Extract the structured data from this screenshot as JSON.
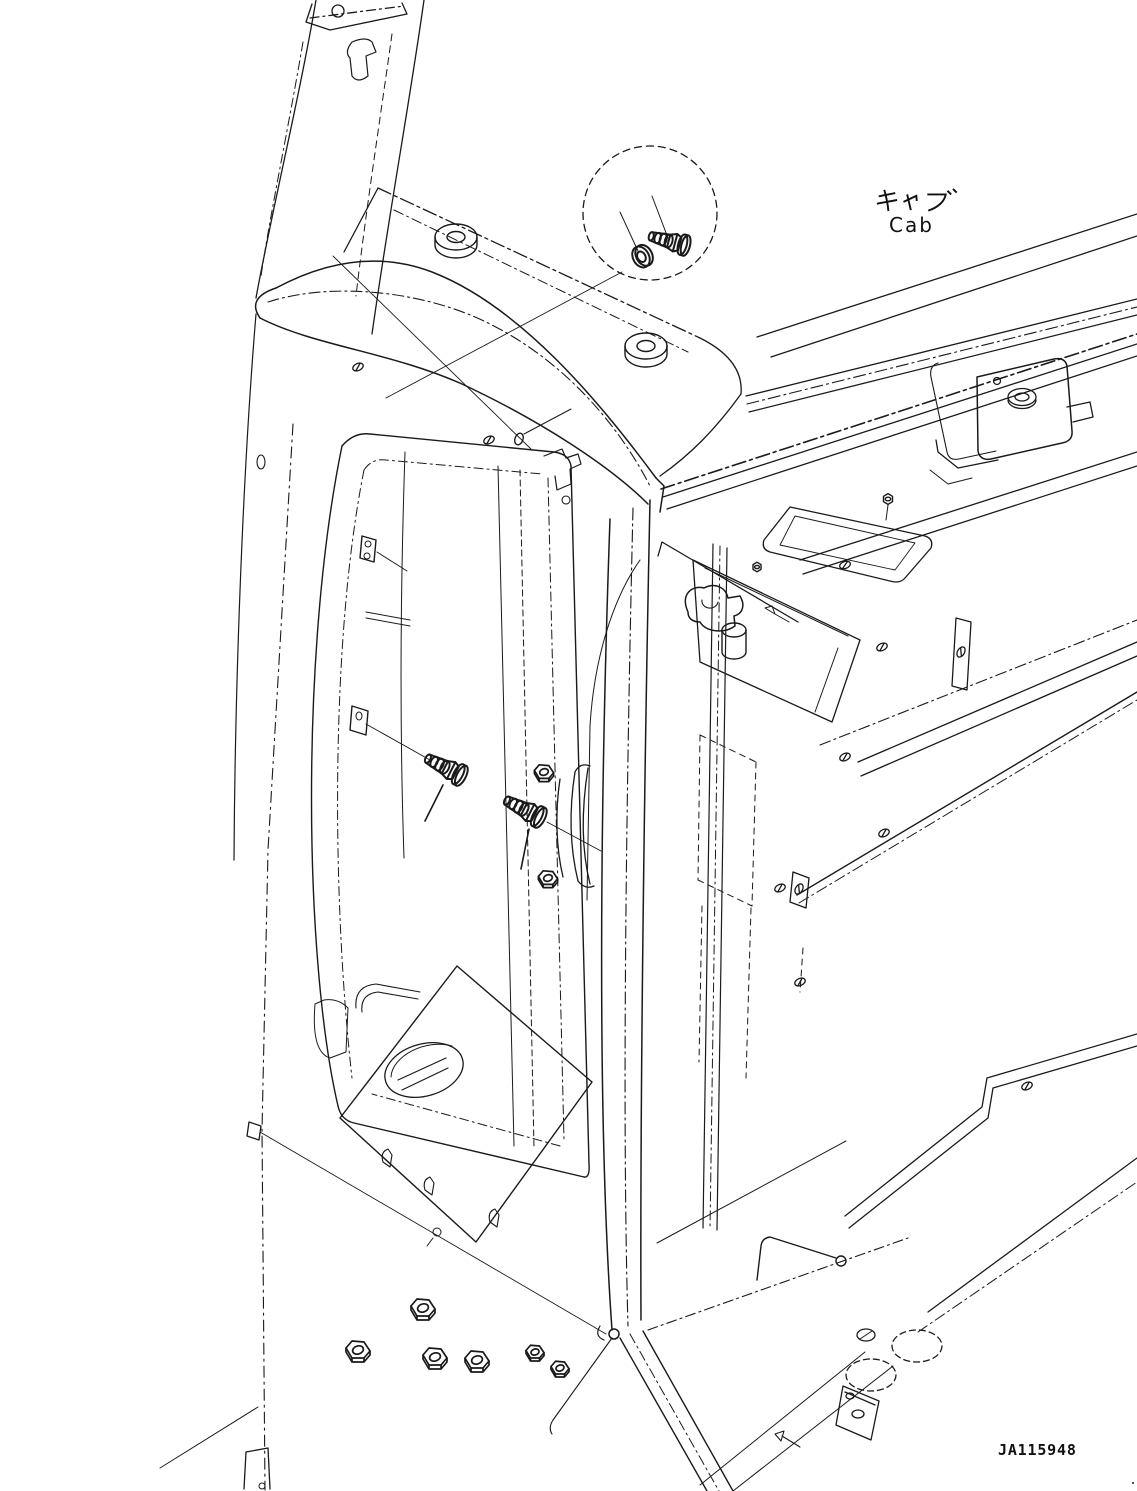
{
  "labels": {
    "component_ja": "キャブ",
    "component_en": "Cab"
  },
  "drawing_number": "JA115948",
  "colors": {
    "line": "#1a1a1a",
    "background": "#ffffff"
  },
  "diagram": {
    "callout": {
      "icon": "detail-callout-circle",
      "contents": [
        "washer",
        "flange-bolt"
      ]
    },
    "fasteners": {
      "flange_bolts_with_leaders": 2,
      "hex_nuts_bottom_row": 6
    }
  }
}
